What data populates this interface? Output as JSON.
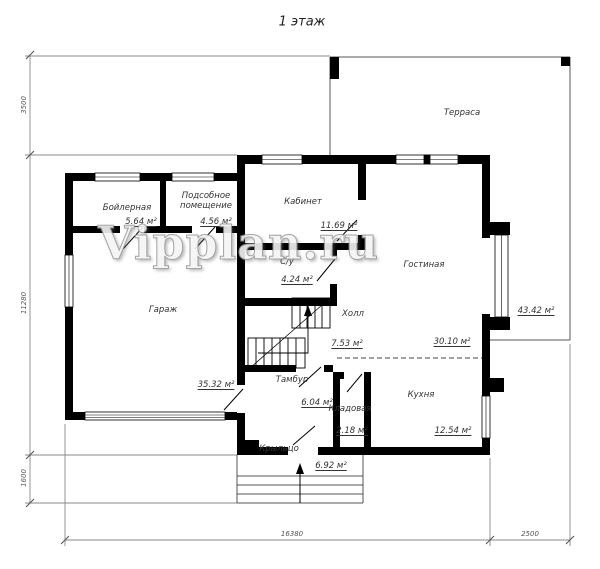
{
  "title": "1 этаж",
  "watermark": "Vipplan.ru",
  "rooms": [
    {
      "name": "Бойлерная",
      "area": "5.64 м²"
    },
    {
      "name": "Подсобное помещение",
      "area": "4.56 м²"
    },
    {
      "name": "Кабинет",
      "area": "11.69 м²"
    },
    {
      "name": "С/у",
      "area": "4.24 м²"
    },
    {
      "name": "Гостиная",
      "area": "30.10 м²"
    },
    {
      "name": "Холл",
      "area": "7.53 м²"
    },
    {
      "name": "Гараж",
      "area": "35.32 м²"
    },
    {
      "name": "Тамбур",
      "area": "6.04 м²"
    },
    {
      "name": "Кладовая",
      "area": "2.18 м²"
    },
    {
      "name": "Кухня",
      "area": "12.54 м²"
    },
    {
      "name": "Крыльцо",
      "area": "6.92 м²"
    },
    {
      "name": "Терраса",
      "area": "43.42 м²"
    }
  ],
  "dimensions": {
    "left_top": "3500",
    "left_middle": "11280",
    "left_bottom": "1600",
    "bottom_width": "16380",
    "bottom_right": "2500"
  },
  "colors": {
    "wall": "#000000",
    "thin_line": "#888888",
    "label_text": "#333333"
  }
}
